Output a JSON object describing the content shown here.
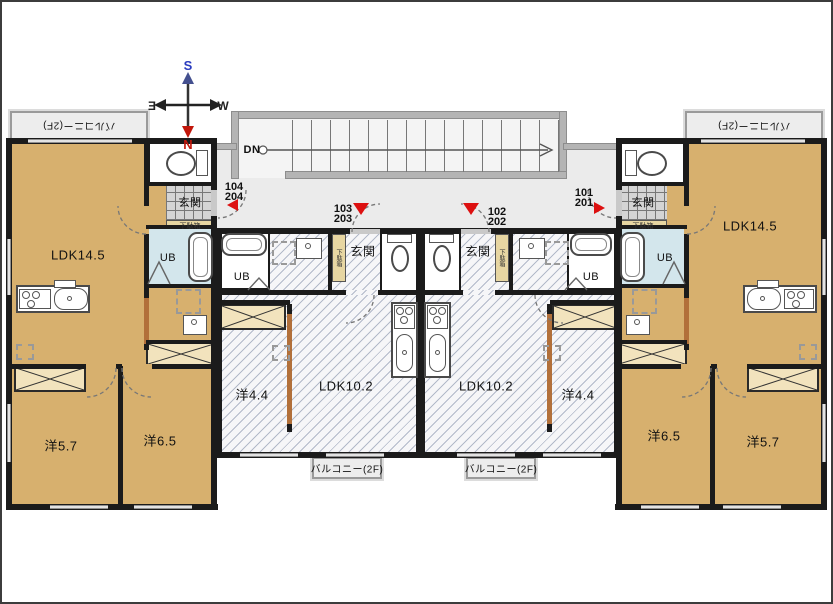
{
  "compass": {
    "north": "N",
    "south": "S",
    "east": "E",
    "west": "W"
  },
  "stairs": {
    "down_label": "DN"
  },
  "labels": {
    "balcony": "バルコニー(2F)",
    "entrance": "玄関",
    "unit_bath": "UB",
    "shoe_cabinet": "下駄箱"
  },
  "units": {
    "far_left": {
      "numbers": [
        "104",
        "204"
      ],
      "ldk": "LDK14.5",
      "bedroom_a": "洋5.7",
      "bedroom_b": "洋6.5"
    },
    "center_left": {
      "numbers": [
        "103",
        "203"
      ],
      "ldk": "LDK10.2",
      "bedroom_a": "洋4.4"
    },
    "center_right": {
      "numbers": [
        "102",
        "202"
      ],
      "ldk": "LDK10.2",
      "bedroom_a": "洋4.4"
    },
    "far_right": {
      "numbers": [
        "101",
        "201"
      ],
      "ldk": "LDK14.5",
      "bedroom_a": "洋6.5",
      "bedroom_b": "洋5.7"
    }
  },
  "colors": {
    "wood_floor": "#d7b06e",
    "wall": "#1b1b1b",
    "hatch_floor": "#f6f6f8",
    "bath_blue": "#d3e6ec",
    "corridor": "#ebebeb",
    "wood_wall": "#b2703a",
    "entry_marker_red": "#dd1010",
    "closet_cream": "#f2e3bd",
    "compass_north": "#c2170b",
    "compass_south": "#2a3bbf"
  }
}
